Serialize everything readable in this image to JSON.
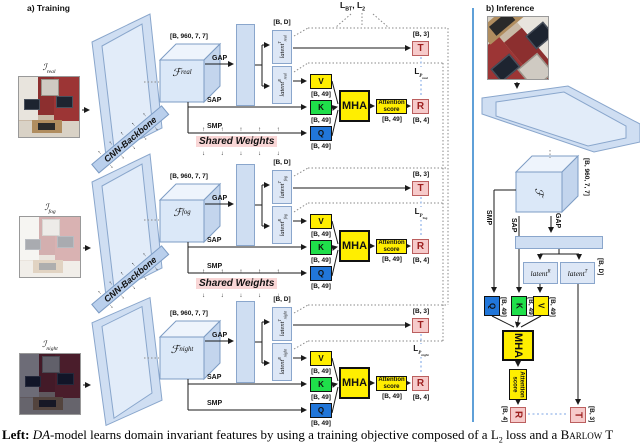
{
  "header": {
    "training": "a) Training",
    "inference": "b) Inference"
  },
  "top_loss": {
    "l1_base": "L",
    "l1_sub": "BT",
    "sep": ", ",
    "l2_base": "L",
    "l2_sub": "2"
  },
  "backbone_label": "CNN-Backbone",
  "shared_weights_label": "Shared Weights",
  "pooling": {
    "gap": "GAP",
    "sap": "SAP",
    "smp": "SMP"
  },
  "dims": {
    "feature_map": "[B, 960, 7, 7]",
    "latent": "[B, D]",
    "tokens": "[B, 49]",
    "translation": "[B, 3]",
    "rotation": "[B, 4]"
  },
  "attention": {
    "v": "V",
    "k": "K",
    "q": "Q",
    "mha": "MHA",
    "score_line1": "Attention",
    "score_line2": "score",
    "t_head": "T",
    "r_head": "R"
  },
  "branches": [
    {
      "domain": "real",
      "input_base": "ℐ",
      "input_sub": "real",
      "feat_base": "ℱ",
      "feat_sub": "real",
      "latent_t_base": "latent",
      "latent_t_sup": "T",
      "latent_t_sub": "real",
      "latent_r_base": "latent",
      "latent_r_sup": "R",
      "latent_r_sub": "real",
      "loss_base": "L",
      "loss_sub": "P",
      "loss_subsub": "real"
    },
    {
      "domain": "fog",
      "input_base": "ℐ",
      "input_sub": "fog",
      "feat_base": "ℱ",
      "feat_sub": "fog",
      "latent_t_base": "latent",
      "latent_t_sup": "T",
      "latent_t_sub": "fog",
      "latent_r_base": "latent",
      "latent_r_sup": "R",
      "latent_r_sub": "fog",
      "loss_base": "L",
      "loss_sub": "P",
      "loss_subsub": "fog"
    },
    {
      "domain": "night",
      "input_base": "ℐ",
      "input_sub": "night",
      "feat_base": "ℱ",
      "feat_sub": "night",
      "latent_t_base": "latent",
      "latent_t_sup": "T",
      "latent_t_sub": "night",
      "latent_r_base": "latent",
      "latent_r_sup": "R",
      "latent_r_sub": "night",
      "loss_base": "L",
      "loss_sub": "P",
      "loss_subsub": "night"
    }
  ],
  "inference": {
    "feat_label": "ℱ",
    "latent_r_base": "latent",
    "latent_r_sup": "R",
    "latent_t_base": "latent",
    "latent_t_sup": "T"
  },
  "caption": {
    "lead": "Left:",
    "model": "DA",
    "body1": "-model learns domain invariant features by using a training objective composed of a L",
    "sub": "2",
    "body2": " loss and a ",
    "emph": "Barlow T"
  },
  "colors": {
    "panel_blue_fill": "#cfdef2",
    "panel_blue_border": "#7d9cc4",
    "v_yellow": "#ffee00",
    "k_green": "#1fdf4a",
    "q_blue": "#2176d9",
    "head_pink": "#f6caca",
    "head_pink_border": "#bb5f5f",
    "shared_weights_bg": "#f9d6d6",
    "separator_blue": "#5fa0d8"
  }
}
